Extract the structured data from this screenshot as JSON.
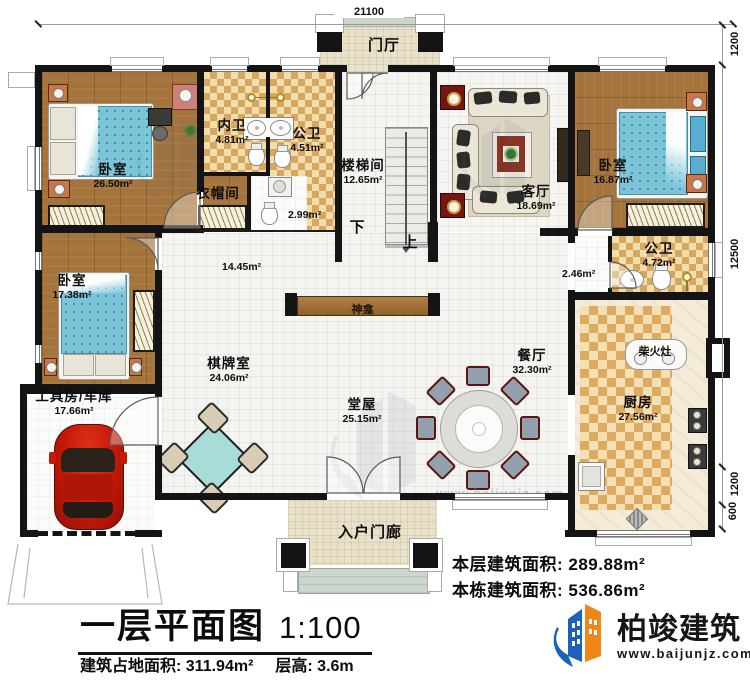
{
  "plan": {
    "dim_top": "21100",
    "dim_right": [
      "1200",
      "12500",
      "1200",
      "600"
    ],
    "foyer": "门厅",
    "entry_porch": "入户门廊",
    "shrine": "神龛",
    "wood_stove": "柴火灶",
    "corridor_area": "14.45m²",
    "bath_lobby_area": "2.46m²",
    "cloak_area": "2.99m²",
    "stair_down": "下",
    "stair_up": "上",
    "rooms": {
      "bedroom_tl": {
        "label": "卧室",
        "area": "26.50m²"
      },
      "inner_bath": {
        "label": "内卫",
        "area": "4.81m²"
      },
      "public_bath_top": {
        "label": "公卫",
        "area": "4.51m²"
      },
      "cloakroom": {
        "label": "衣帽间"
      },
      "stairwell": {
        "label": "楼梯间",
        "area": "12.65m²"
      },
      "living_room": {
        "label": "客厅",
        "area": "18.69m²"
      },
      "bedroom_tr": {
        "label": "卧室",
        "area": "16.87m²"
      },
      "public_bath_right": {
        "label": "公卫",
        "area": "4.72m²"
      },
      "bedroom_left": {
        "label": "卧室",
        "area": "17.38m²"
      },
      "game_room": {
        "label": "棋牌室",
        "area": "24.06m²"
      },
      "main_hall": {
        "label": "堂屋",
        "area": "25.15m²"
      },
      "dining_room": {
        "label": "餐厅",
        "area": "32.30m²"
      },
      "kitchen": {
        "label": "厨房",
        "area": "27.56m²"
      },
      "garage": {
        "label": "工具房/车库",
        "area": "17.66m²"
      }
    }
  },
  "footer": {
    "this_floor_label": "本层建筑面积: ",
    "this_floor_value": "289.88m²",
    "building_label": "本栋建筑面积: ",
    "building_value": "536.86m²",
    "title": "一层平面图",
    "scale": "1:100",
    "land_label": "建筑占地面积: ",
    "land_value": "311.94m²",
    "height_label": "层高: ",
    "height_value": "3.6m"
  },
  "brand": {
    "name": "柏竣建筑",
    "url": "www.baijunjz.com"
  },
  "colors": {
    "wall": "#141414",
    "wood_floor": "#a4743c",
    "tile_dark": "#d8a75f",
    "tile_light": "#f2ddad",
    "accent_red": "#741712",
    "bed_blue": "#7cc4d8",
    "logo_blue": "#1a63b8",
    "logo_orange": "#f08618"
  }
}
